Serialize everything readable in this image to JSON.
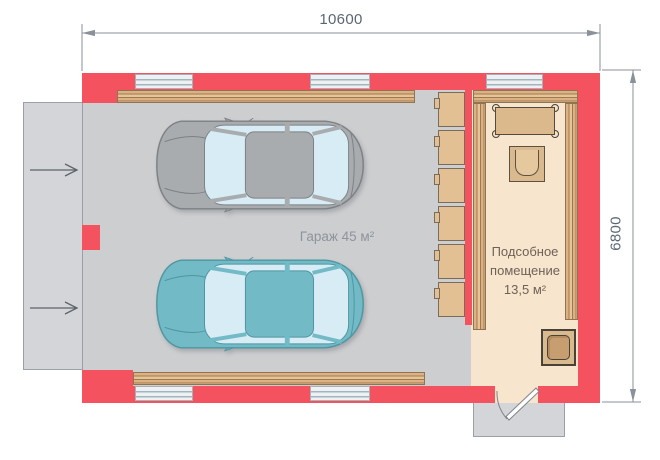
{
  "plan": {
    "top_dimension": "10600",
    "right_dimension": "6800",
    "garage": {
      "label": "Гараж 45 м²"
    },
    "utility": {
      "lines": [
        "Подсобное",
        "помещение",
        "13,5 м²"
      ]
    }
  },
  "colors": {
    "wall": "#f4525e",
    "garage_floor": "#cdced0",
    "utility_floor": "#f8e5ce",
    "outdoor": "#d4d5d8",
    "outdoor_edge": "#9aa0a6",
    "wood": "#dcb284",
    "wood_line": "#a07a4e",
    "wood_edge": "#8f7352",
    "cabinet": "#e2c093",
    "cabinet_edge": "#7a6c5d",
    "window_bg": "#eef0f2",
    "window_line": "#9fb6c0",
    "car_gray": "#a9acae",
    "car_gray_edge": "#7d8184",
    "car_teal": "#72bac5",
    "car_teal_edge": "#4f96a3",
    "glass": "#d8ecf6",
    "furniture": "#d9b98e",
    "furniture_edge": "#5f5142",
    "dim_line": "#8a9199",
    "dim_text": "#5a6772",
    "garage_text": "#8d949b",
    "utility_text": "#6e6257",
    "door_line": "#7d848b",
    "arrow": "#5d646b"
  }
}
